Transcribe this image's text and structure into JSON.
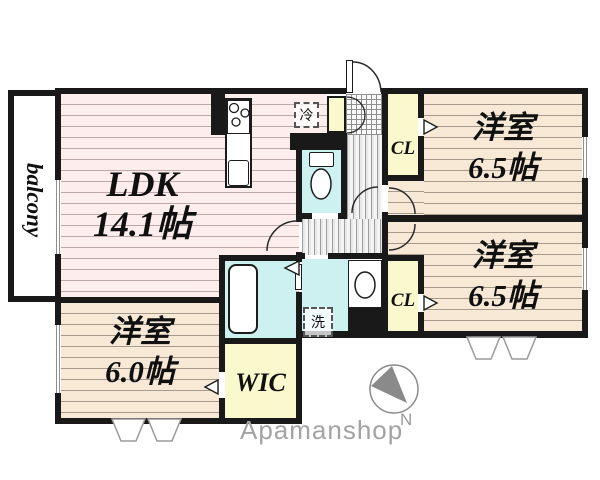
{
  "floorplan": {
    "rooms": {
      "balcony": {
        "name": "balcony"
      },
      "ldk": {
        "name": "LDK",
        "area": "14.1帖"
      },
      "bedroom_top_right": {
        "name": "洋室",
        "area": "6.5帖"
      },
      "bedroom_bottom_right": {
        "name": "洋室",
        "area": "6.5帖"
      },
      "bedroom_bottom_left": {
        "name": "洋室",
        "area": "6.0帖"
      },
      "wic": {
        "name": "WIC"
      },
      "closet_top": {
        "name": "CL"
      },
      "closet_bottom": {
        "name": "CL"
      }
    },
    "fixtures": {
      "refrigerator_label": "冷",
      "washer_label": "洗"
    },
    "compass": {
      "north_label": "N"
    },
    "branding": {
      "watermark": "Apamanshop"
    },
    "colors": {
      "wall": "#191919",
      "ldk_floor": "#fdeded",
      "bedroom_floor": "#f8e9d7",
      "wet_area_floor": "#cdf1f1",
      "storage_floor": "#faf8cd",
      "hall_floor": "#e7e7e7",
      "watermark_gray": "#a3a3a3"
    }
  }
}
